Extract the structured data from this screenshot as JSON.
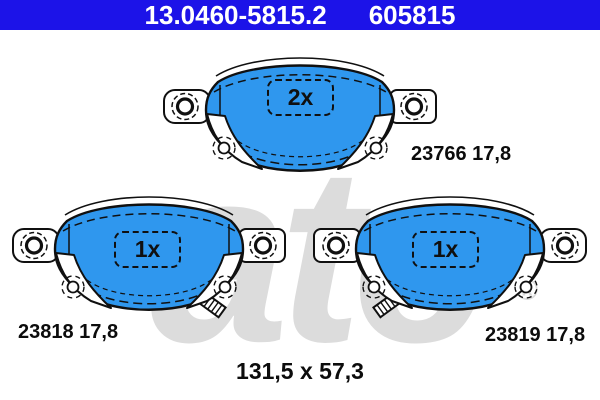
{
  "header": {
    "catalog_number": "13.0460-5815.2",
    "reference_number": "605815",
    "bg_color": "#1c13e8",
    "text_color": "#ffffff"
  },
  "watermark": {
    "text": "ate",
    "registered_mark": "®",
    "color": "#dcdcdc"
  },
  "pads": [
    {
      "position": "top",
      "quantity_label": "2x",
      "part_label": "23766 17,8"
    },
    {
      "position": "bottom-left",
      "quantity_label": "1x",
      "part_label": "23818 17,8"
    },
    {
      "position": "bottom-right",
      "quantity_label": "1x",
      "part_label": "23819 17,8"
    }
  ],
  "dimensions_label": "131,5 x 57,3",
  "colors": {
    "pad_fill": "#2f97ee",
    "outline": "#101010",
    "plate_fill": "#ffffff"
  }
}
